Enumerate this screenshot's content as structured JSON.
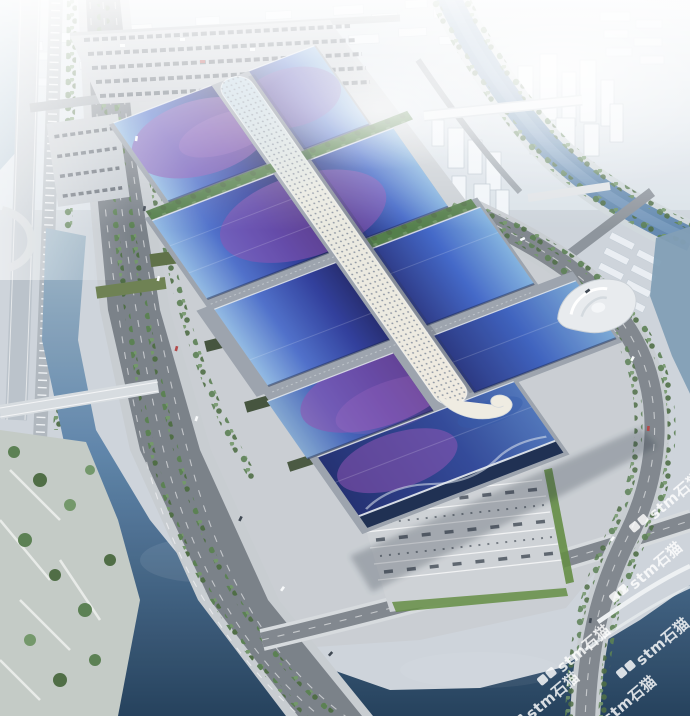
{
  "image": {
    "type": "aerial architectural rendering",
    "subject": "large exhibition and convention center complex with blue-purple gradient hall roofs and a white serpentine central canopy spine, flanked by a tree-lined boulevard, canals, riverside parks, a stepped south plaza and a hazy city skyline"
  },
  "watermark": {
    "text": "stm石猫",
    "color": "#ffffff",
    "opacity": 0.82,
    "rotation_deg": -40,
    "instances": 6,
    "logo": "two rounded-square cat icons"
  },
  "palette": {
    "sky_haze": "#e8eef3",
    "ground": "#ccd3da",
    "city_block": "#eef2f6",
    "asphalt": "#767d85",
    "plaza": "#c8cdd2",
    "roof_deep_blue": "#232c7d",
    "roof_blue": "#3d63c6",
    "roof_light_blue": "#8fb8e2",
    "roof_purple": "#8a4fb0",
    "spine_canopy": "#f1efe4",
    "water_light": "#9fb6c6",
    "water_mid": "#5b82a8",
    "water_dark": "#1f3d59",
    "tree_green": "#567c4e",
    "lawn_green": "#5f8a3e",
    "facade_dark": "#17294d"
  }
}
